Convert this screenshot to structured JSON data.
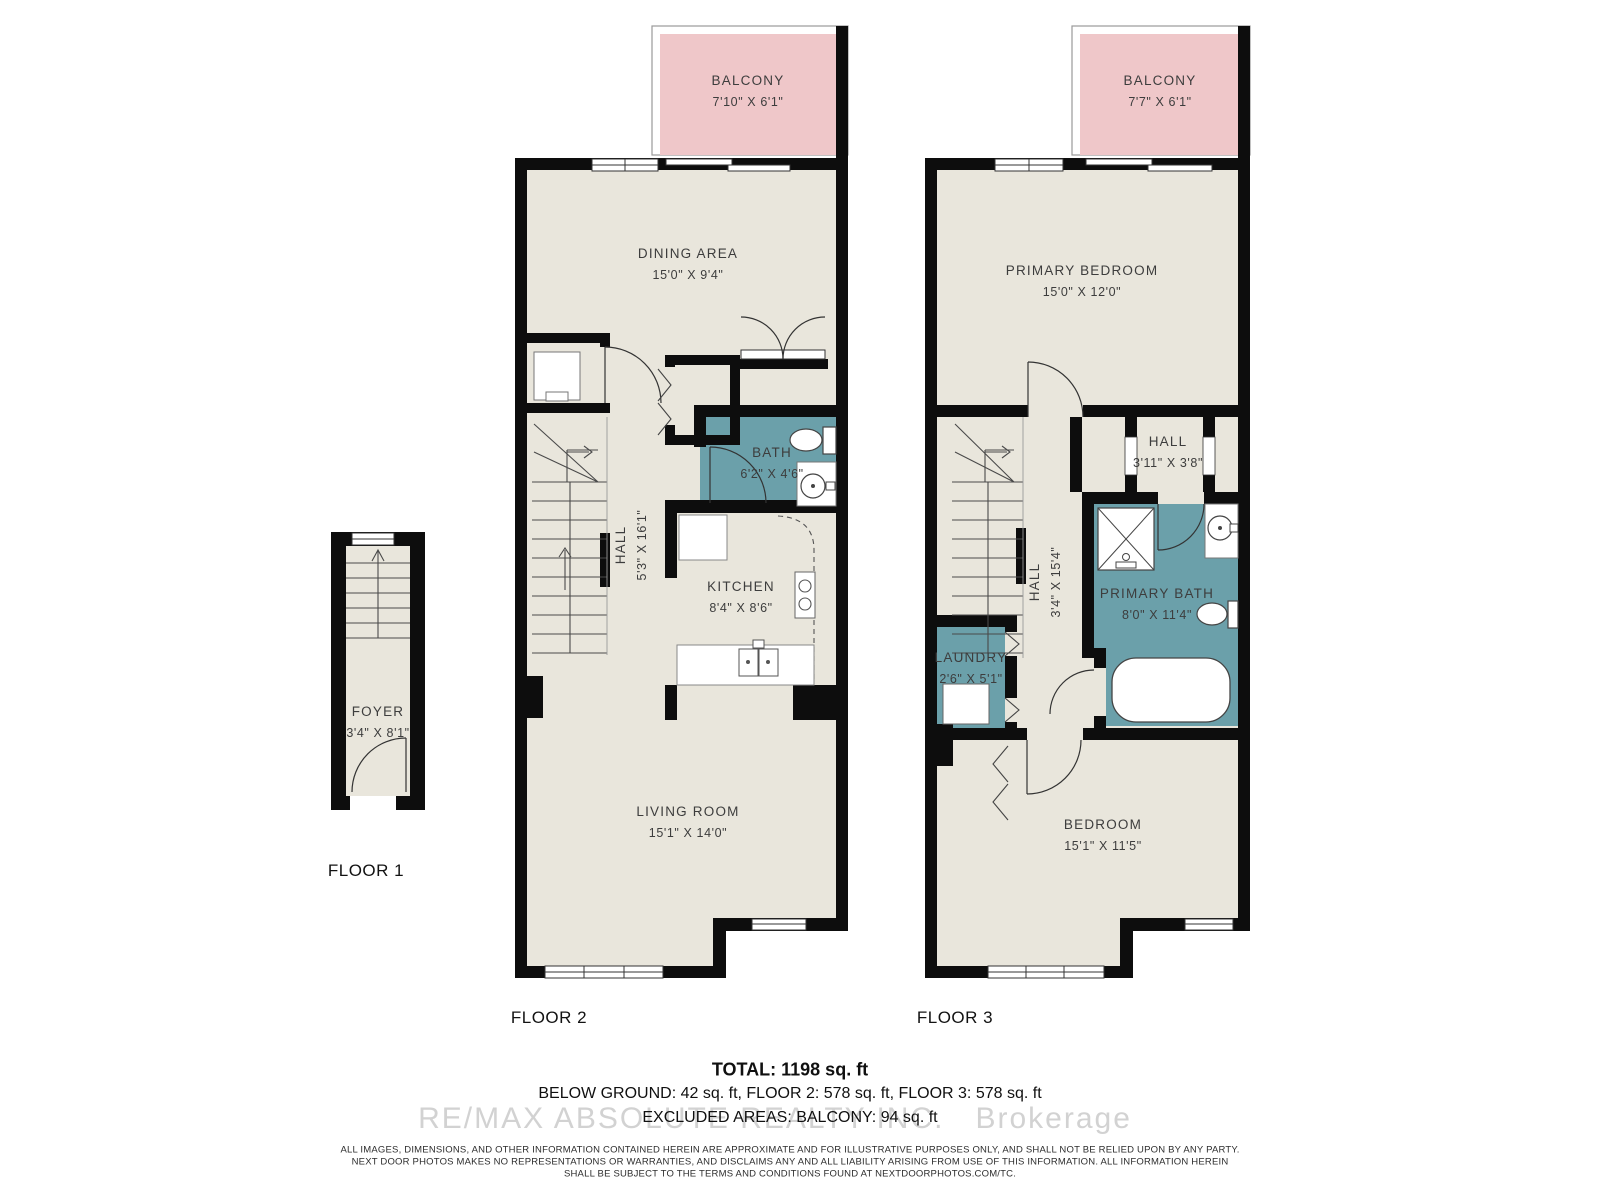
{
  "colors": {
    "floor_fill": "#e9e6dc",
    "wall": "#0d0d0d",
    "balcony_fill": "#efc7c9",
    "wet_room_fill": "#6ba0aa",
    "label_text": "#3d3d3d"
  },
  "floor1": {
    "label": "FLOOR 1",
    "foyer": {
      "name": "FOYER",
      "dims": "3'4\" X 8'1\""
    }
  },
  "floor2": {
    "label": "FLOOR 2",
    "balcony": {
      "name": "BALCONY",
      "dims": "7'10\" X 6'1\""
    },
    "dining": {
      "name": "DINING AREA",
      "dims": "15'0\" X 9'4\""
    },
    "hall": {
      "name": "HALL",
      "dims": "5'3\" X 16'1\""
    },
    "bath": {
      "name": "BATH",
      "dims": "6'2\" X 4'6\""
    },
    "kitchen": {
      "name": "KITCHEN",
      "dims": "8'4\" X 8'6\""
    },
    "living": {
      "name": "LIVING ROOM",
      "dims": "15'1\" X 14'0\""
    }
  },
  "floor3": {
    "label": "FLOOR 3",
    "balcony": {
      "name": "BALCONY",
      "dims": "7'7\" X 6'1\""
    },
    "primary_bedroom": {
      "name": "PRIMARY BEDROOM",
      "dims": "15'0\" X 12'0\""
    },
    "hall_small": {
      "name": "HALL",
      "dims": "3'11\" X 3'8\""
    },
    "hall": {
      "name": "HALL",
      "dims": "3'4\" X 15'4\""
    },
    "primary_bath": {
      "name": "PRIMARY BATH",
      "dims": "8'0\" X 11'4\""
    },
    "laundry": {
      "name": "LAUNDRY",
      "dims": "2'6\" X 5'1\""
    },
    "bedroom": {
      "name": "BEDROOM",
      "dims": "15'1\" X 11'5\""
    }
  },
  "summary": {
    "total": "TOTAL: 1198 sq. ft",
    "breakdown": "BELOW GROUND: 42 sq. ft, FLOOR 2: 578 sq. ft, FLOOR 3: 578 sq. ft",
    "excluded": "EXCLUDED AREAS: BALCONY: 94 sq. ft"
  },
  "watermark": "RE/MAX ABSOLUTE REALTY INC.   Brokerage",
  "disclaimer": [
    "ALL IMAGES, DIMENSIONS, AND OTHER INFORMATION CONTAINED HEREIN ARE APPROXIMATE AND FOR ILLUSTRATIVE PURPOSES ONLY, AND SHALL NOT BE RELIED UPON BY ANY PARTY.",
    "NEXT DOOR PHOTOS MAKES NO REPRESENTATIONS OR WARRANTIES, AND DISCLAIMS ANY AND ALL LIABILITY ARISING FROM USE OF THIS INFORMATION. ALL INFORMATION HEREIN",
    "SHALL BE SUBJECT TO THE TERMS AND CONDITIONS FOUND AT NEXTDOORPHOTOS.COM/TC."
  ]
}
